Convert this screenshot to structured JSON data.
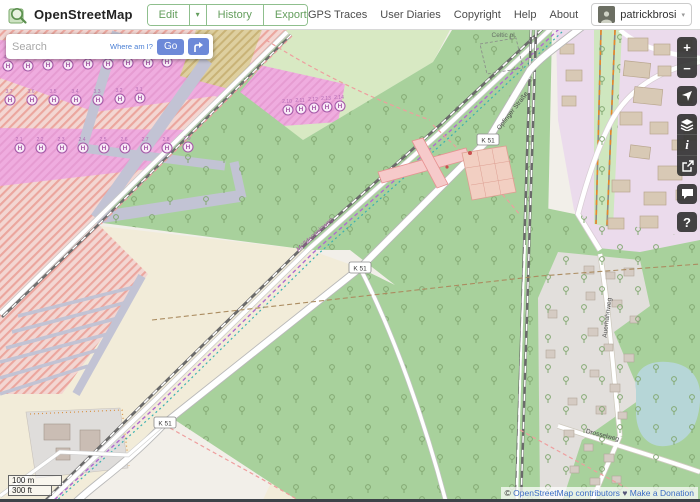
{
  "header": {
    "brand": "OpenStreetMap",
    "edit_label": "Edit",
    "edit_caret": "▾",
    "history_label": "History",
    "export_label": "Export",
    "nav_links": [
      "GPS Traces",
      "User Diaries",
      "Copyright",
      "Help",
      "About"
    ],
    "username": "patrickbrosi",
    "user_caret": "▾"
  },
  "search": {
    "placeholder": "Search",
    "where_am_i": "Where am I?",
    "go_label": "Go"
  },
  "map_controls": {
    "zoom_in": "+",
    "zoom_out": "−",
    "info": "i",
    "help": "?",
    "icons": [
      "plus-icon",
      "minus-icon",
      "locate-arrow-icon",
      "layers-icon",
      "info-icon",
      "share-icon",
      "note-bubble-icon",
      "question-icon"
    ]
  },
  "scale": {
    "metric": "100 m",
    "imperial": "300 ft"
  },
  "attribution": {
    "copyright_prefix": "©",
    "osm_link": "OpenStreetMap contributors",
    "heart": "♥",
    "donate_link": "Make a Donation"
  },
  "map": {
    "road_ref": "K 51",
    "street_upper": "Opfinger Straße",
    "street_residential_vertical": "Auerhahnweg",
    "street_residential_diagonal": "Drosselweg",
    "area_label": "Celtic pl.",
    "path_label": "Mülldeponieweg",
    "helipad_letter": "H",
    "helipads": {
      "g1": [
        "4.9",
        "4.8",
        "4.7",
        "4.6",
        "4.5",
        "4.4",
        "4.3",
        "4.2",
        "4.1"
      ],
      "g2": [
        "3.7",
        "3.6",
        "3.5",
        "3.4",
        "3.3",
        "3.2",
        "3.1"
      ],
      "g3": [
        "2.1",
        "2.2",
        "2.3",
        "2.4",
        "2.5",
        "2.6",
        "2.7",
        "2.8",
        "2.9"
      ],
      "g4": [
        "2.10",
        "2.11",
        "2.12",
        "2.13",
        "2.14"
      ]
    },
    "colors": {
      "forest": "#a8d19c",
      "meadow": "#d8e9c3",
      "field": "#f2ecd9",
      "military_hatch": "#eba69e",
      "helipad_area": "#efacdf",
      "retail": "#ebdbec",
      "residential": "#e2dfdc",
      "water": "#b6d6d7",
      "taxiway": "#c2c3d4",
      "tram_orange": "#e8882a",
      "accent_blue": "#6d89d8",
      "osm_green": "#649e5d"
    }
  }
}
